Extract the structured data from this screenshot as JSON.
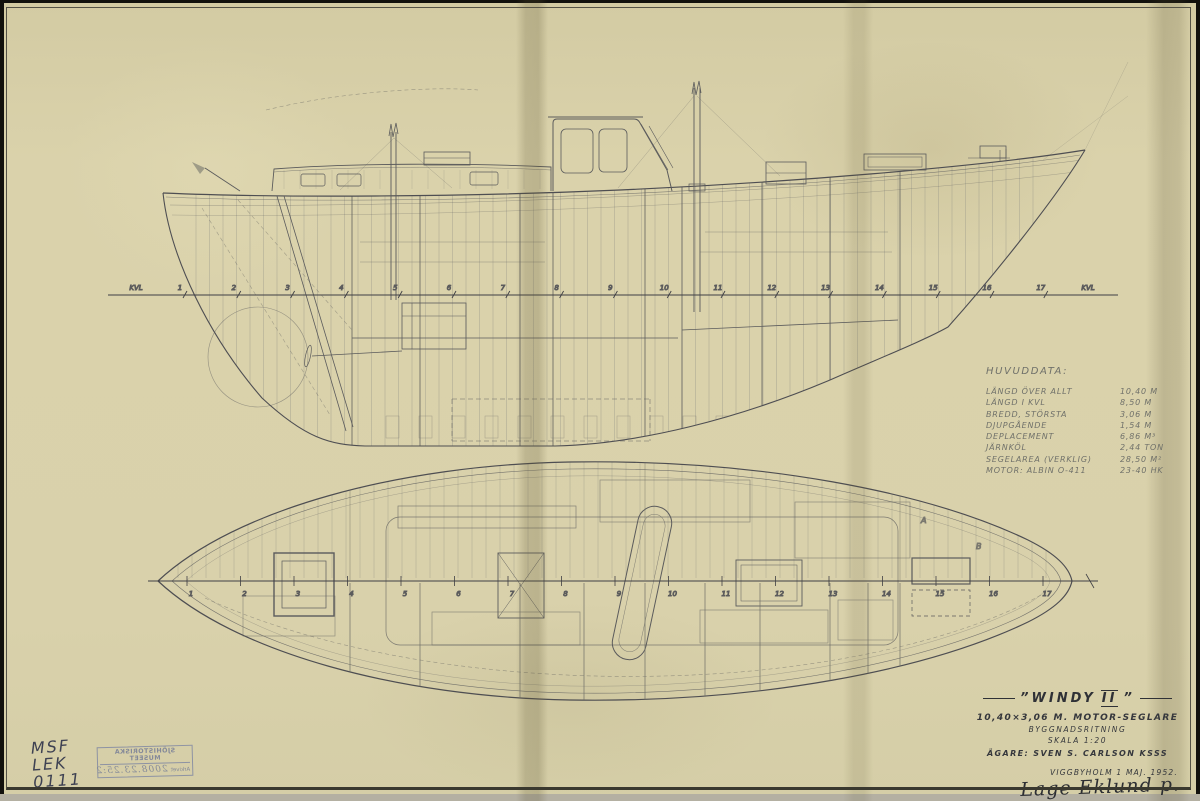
{
  "colors": {
    "paper": "#d9d1ab",
    "pencil_line": "#75756d",
    "dark_line": "#4b4b4f",
    "ink_text": "#2f3136",
    "stamp_blue": "#8289a3"
  },
  "drawing": {
    "profile_stations": [
      "KVL",
      "1",
      "2",
      "3",
      "4",
      "5",
      "6",
      "7",
      "8",
      "9",
      "10",
      "11",
      "12",
      "13",
      "14",
      "15",
      "16",
      "17",
      "KVL"
    ],
    "plan_stations": [
      "1",
      "2",
      "3",
      "4",
      "5",
      "6",
      "7",
      "8",
      "9",
      "10",
      "11",
      "12",
      "13",
      "14",
      "15",
      "16",
      "17"
    ],
    "frame_letters": [
      "A",
      "B"
    ]
  },
  "huvuddata": {
    "title": "HUVUDDATA:",
    "rows": [
      {
        "label": "LÄNGD ÖVER ALLT",
        "value": "10,40 M"
      },
      {
        "label": "LÄNGD I KVL",
        "value": "8,50 M"
      },
      {
        "label": "BREDD, STÖRSTA",
        "value": "3,06 M"
      },
      {
        "label": "DJUPGÅENDE",
        "value": "1,54 M"
      },
      {
        "label": "DEPLACEMENT",
        "value": "6,86 M³"
      },
      {
        "label": "JÄRNKÖL",
        "value": "2,44 TON"
      },
      {
        "label": "SEGELAREA (VERKLIG)",
        "value": "28,50 M²"
      },
      {
        "label": "MOTOR: ALBIN O-411",
        "value": "23-40 HK"
      }
    ]
  },
  "title_block": {
    "name": "”WINDY",
    "numeral": "II",
    "quote_close": "”",
    "subtitle": "10,40×3,06 M.  MOTOR-SEGLARE",
    "line2": "BYGGNADSRITNING",
    "line3": "SKALA 1:20",
    "owner": "ÄGARE: SVEN S. CARLSON  KSSS",
    "place_date": "VIGGBYHOLM  1 MAJ. 1952.",
    "signature": "Lage Eklund p."
  },
  "archive": {
    "code_lines": [
      "MSF",
      "LEK",
      "0111"
    ],
    "stamp": {
      "line1": "SJÖHISTORISKA MUSEET",
      "line2": "Arkivet",
      "number": "2008.23.25:2"
    }
  }
}
